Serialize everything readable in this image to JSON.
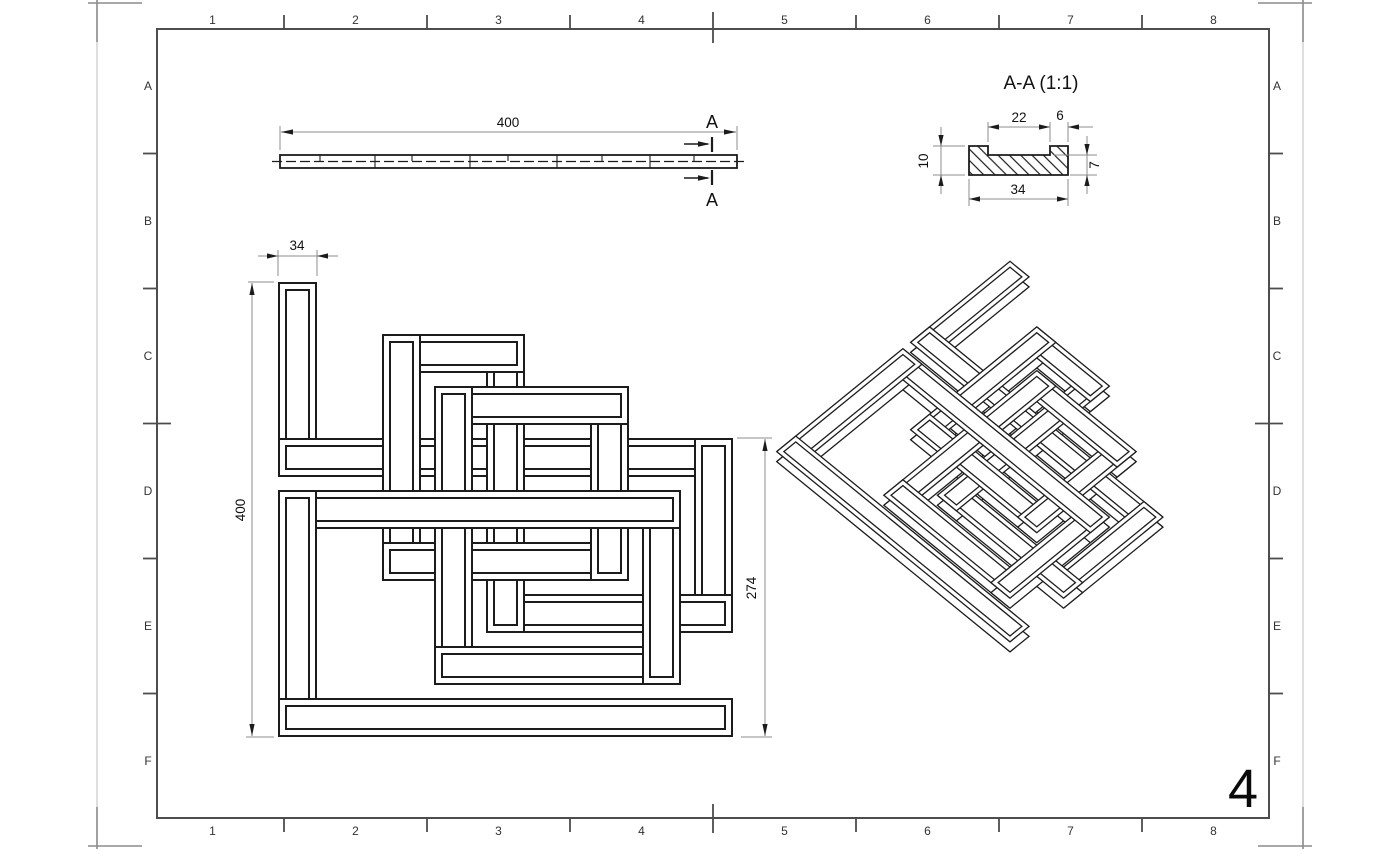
{
  "colors": {
    "line": "#1c1c1c",
    "dim": "#8c8c8c",
    "frame": "#4d4d4d",
    "trim": "#9a9a9a",
    "paper": "#ffffff"
  },
  "border": {
    "top": [
      "1",
      "2",
      "3",
      "4",
      "5",
      "6",
      "7",
      "8"
    ],
    "bottom": [
      "1",
      "2",
      "3",
      "4",
      "5",
      "6",
      "7",
      "8"
    ],
    "left": [
      "A",
      "B",
      "C",
      "D",
      "E",
      "F"
    ],
    "right": [
      "A",
      "B",
      "C",
      "D",
      "E",
      "F"
    ]
  },
  "sheet_number": "4",
  "side_view": {
    "dim_length": "400",
    "section_label": "A"
  },
  "section_view": {
    "title": "A-A (1:1)",
    "dims": {
      "notch_width": "22",
      "edge_offset": "6",
      "height": "10",
      "base_thickness": "7",
      "width": "34"
    }
  },
  "front_view": {
    "dims": {
      "strip_width": "34",
      "height": "400",
      "partial_height": "274"
    }
  }
}
